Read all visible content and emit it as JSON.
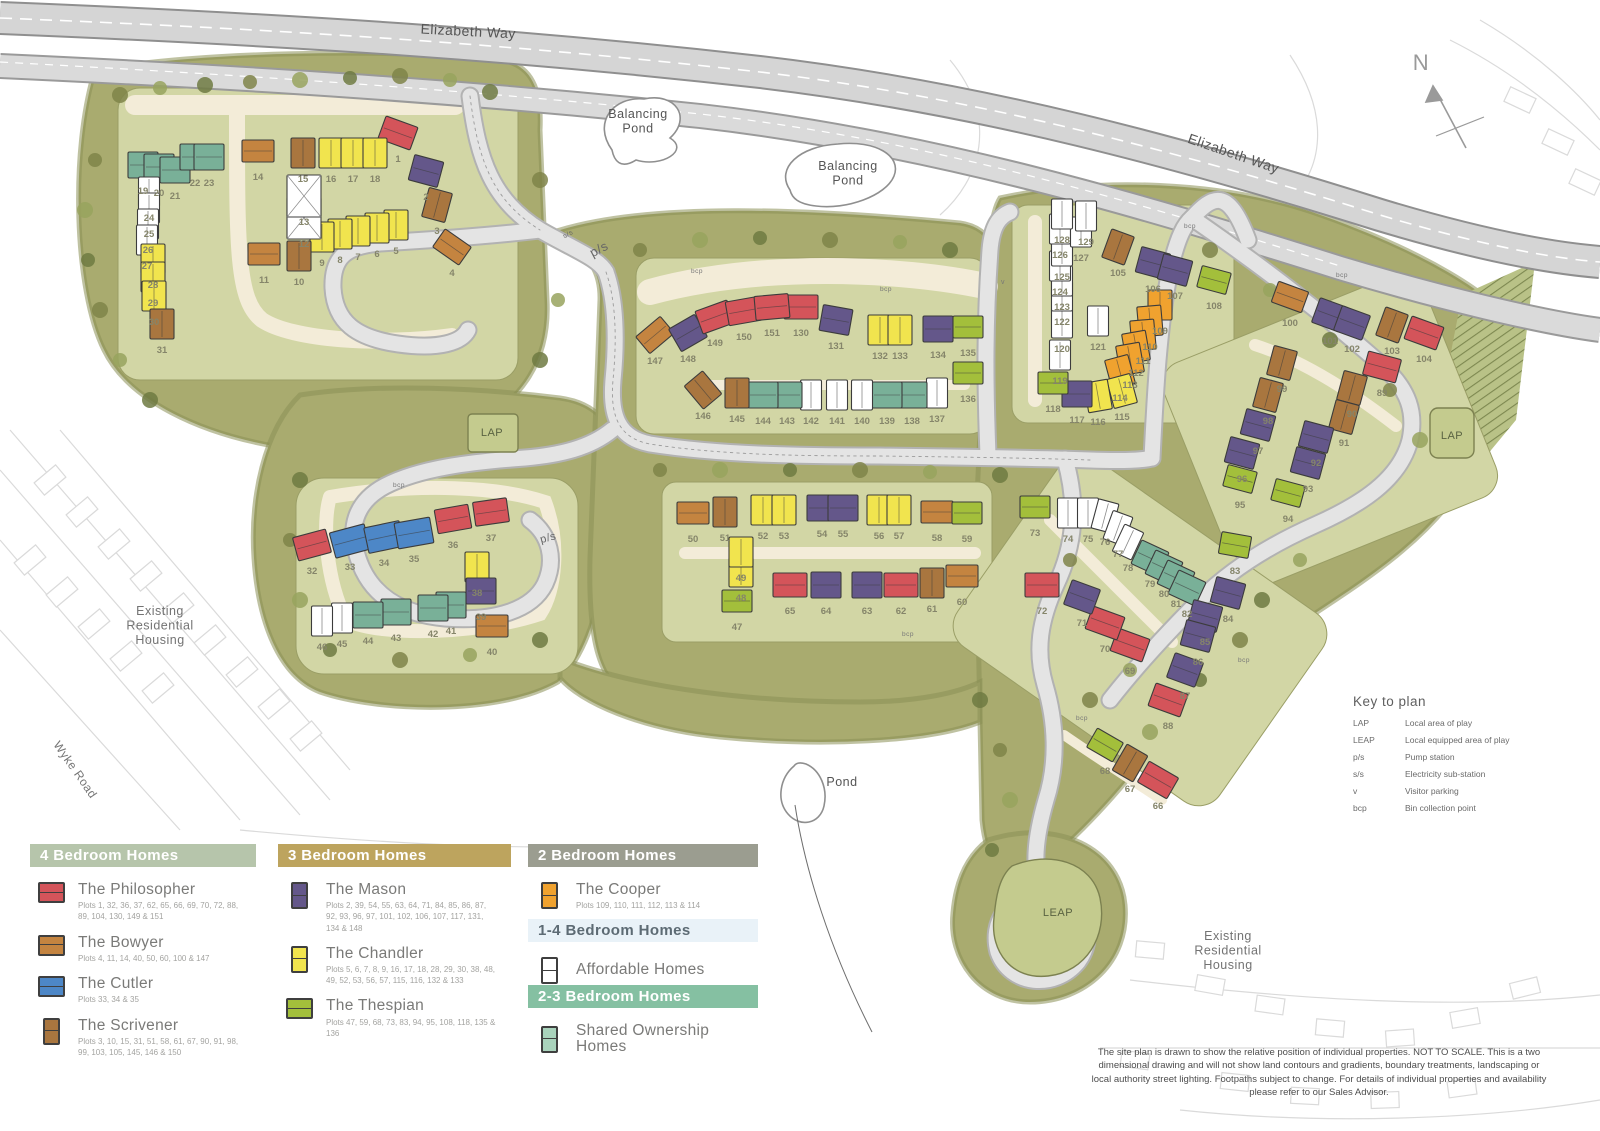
{
  "legend": {
    "panels": [
      {
        "title": "4 Bedroom Homes",
        "header_bg": "#b6c5ab",
        "entries": [
          {
            "name": "The Philosopher",
            "plots": "Plots 1, 32, 36, 37, 62, 65, 66, 69, 70, 72, 88, 89, 104, 130, 149 & 151",
            "color": "#d4545a",
            "shape": "h"
          },
          {
            "name": "The Bowyer",
            "plots": "Plots 4, 11, 14, 40, 50, 60, 100 & 147",
            "color": "#c48440",
            "shape": "h"
          },
          {
            "name": "The Cutler",
            "plots": "Plots 33, 34 & 35",
            "color": "#4d87c7",
            "shape": "h"
          },
          {
            "name": "The Scrivener",
            "plots": "Plots 3, 10, 15, 31, 51, 58, 61, 67, 90, 91, 98, 99, 103, 105, 145, 146 & 150",
            "color": "#a9763f",
            "shape": "v"
          }
        ]
      },
      {
        "title": "3 Bedroom Homes",
        "header_bg": "#bda45e",
        "entries": [
          {
            "name": "The Mason",
            "plots": "Plots 2, 39, 54, 55, 63, 64, 71, 84, 85, 86, 87, 92, 93, 96, 97, 101, 102, 106, 107, 117, 131, 134 & 148",
            "color": "#64578a",
            "shape": "v"
          },
          {
            "name": "The Chandler",
            "plots": "Plots 5, 6, 7, 8, 9, 16, 17, 18, 28, 29, 30, 38, 48, 49, 52, 53, 56, 57, 115, 116, 132 & 133",
            "color": "#f1e44e",
            "shape": "v"
          },
          {
            "name": "The Thespian",
            "plots": "Plots 47, 59, 68, 73, 83, 94, 95, 108, 118, 135 & 136",
            "color": "#a3bf3b",
            "shape": "h"
          }
        ]
      },
      {
        "title": "2 Bedroom Homes",
        "header_bg": "#9b9d90",
        "entries": [
          {
            "name": "The Cooper",
            "plots": "Plots 109, 110, 111, 112, 113 & 114",
            "color": "#f0a22f",
            "shape": "v"
          }
        ]
      },
      {
        "title": "1-4 Bedroom Homes",
        "header_bg": "#e9f2f8",
        "entries": [
          {
            "name": "Affordable Homes",
            "plots": "",
            "color": "#ffffff",
            "shape": "v"
          }
        ]
      },
      {
        "title": "2-3 Bedroom Homes",
        "header_bg": "#85c0a2",
        "entries": [
          {
            "name": "Shared Ownership Homes",
            "plots": "",
            "color": "#a9d3bc",
            "shape": "v"
          }
        ]
      }
    ]
  },
  "key_to_plan": {
    "title": "Key to plan",
    "rows": [
      [
        "LAP",
        "Local area of play"
      ],
      [
        "LEAP",
        "Local equipped area of play"
      ],
      [
        "p/s",
        "Pump station"
      ],
      [
        "s/s",
        "Electricity sub-station"
      ],
      [
        "v",
        "Visitor parking"
      ],
      [
        "bcp",
        "Bin collection point"
      ]
    ]
  },
  "disclaimer": "The site plan is drawn to show the relative position of individual properties. NOT TO SCALE. This is a two dimensional drawing and will not show land contours and gradients, boundary treatments, landscaping or local authority street lighting. Footpaths subject to change. For details of individual properties and availability please refer to our Sales Advisor.",
  "compass": {
    "label": "N"
  },
  "map_labels": [
    {
      "t": "Elizabeth Way",
      "x": 468,
      "y": 36,
      "r": 3,
      "s": 14,
      "c": "#555555"
    },
    {
      "t": "Elizabeth Way",
      "x": 1232,
      "y": 158,
      "r": 19,
      "s": 14,
      "c": "#555555"
    },
    {
      "t": "Balancing|Pond",
      "x": 638,
      "y": 118,
      "r": 0,
      "s": 12.5,
      "c": "#555555"
    },
    {
      "t": "Balancing|Pond",
      "x": 848,
      "y": 170,
      "r": 0,
      "s": 12.5,
      "c": "#555555"
    },
    {
      "t": "Pond",
      "x": 842,
      "y": 786,
      "r": 0,
      "s": 12.5,
      "c": "#555555"
    },
    {
      "t": "Wyke Road",
      "x": 72,
      "y": 772,
      "r": 55,
      "s": 12,
      "c": "#767676"
    },
    {
      "t": "Existing|Residential|Housing",
      "x": 160,
      "y": 615,
      "r": 0,
      "s": 12.5,
      "c": "#737373"
    },
    {
      "t": "Existing|Residential|Housing",
      "x": 1228,
      "y": 940,
      "r": 0,
      "s": 12.5,
      "c": "#737373"
    },
    {
      "t": "LAP",
      "x": 492,
      "y": 436,
      "r": 0,
      "s": 11,
      "c": "#5a6342"
    },
    {
      "t": "LAP",
      "x": 1452,
      "y": 439,
      "r": 0,
      "s": 11,
      "c": "#5a6342"
    },
    {
      "t": "LEAP",
      "x": 1058,
      "y": 916,
      "r": 0,
      "s": 11,
      "c": "#5a6342"
    },
    {
      "t": "p/s",
      "x": 601,
      "y": 253,
      "r": -28,
      "s": 13,
      "c": "#666666"
    },
    {
      "t": "p/s",
      "x": 549,
      "y": 541,
      "r": -15,
      "s": 11,
      "c": "#666666"
    },
    {
      "t": "s/s",
      "x": 569,
      "y": 236,
      "r": -28,
      "s": 7,
      "c": "#666666"
    },
    {
      "t": "v",
      "x": 1003,
      "y": 284,
      "r": 0,
      "s": 7,
      "c": "#777777"
    },
    {
      "t": "bcp",
      "x": 697,
      "y": 273,
      "r": 0,
      "s": 6.5,
      "c": "#777777"
    },
    {
      "t": "bcp",
      "x": 886,
      "y": 291,
      "r": 0,
      "s": 6.5,
      "c": "#777777"
    },
    {
      "t": "bcp",
      "x": 1190,
      "y": 228,
      "r": 0,
      "s": 6.5,
      "c": "#777777"
    },
    {
      "t": "bcp",
      "x": 1342,
      "y": 277,
      "r": 0,
      "s": 6.5,
      "c": "#777777"
    },
    {
      "t": "bcp",
      "x": 399,
      "y": 487,
      "r": 0,
      "s": 6.5,
      "c": "#777777"
    },
    {
      "t": "bcp",
      "x": 908,
      "y": 636,
      "r": 0,
      "s": 6.5,
      "c": "#777777"
    },
    {
      "t": "bcp",
      "x": 1244,
      "y": 662,
      "r": 0,
      "s": 6.5,
      "c": "#777777"
    },
    {
      "t": "bcp",
      "x": 1082,
      "y": 720,
      "r": 0,
      "s": 6.5,
      "c": "#777777"
    },
    {
      "t": "N",
      "x": 1421,
      "y": 70,
      "r": 0,
      "s": 22,
      "c": "#9a9a9a"
    }
  ],
  "house_types": {
    "P": {
      "name": "The Philosopher",
      "color": "#d4545a",
      "w": 34,
      "h": 24
    },
    "B": {
      "name": "The Bowyer",
      "color": "#c48440",
      "w": 32,
      "h": 22
    },
    "C": {
      "name": "The Cutler",
      "color": "#4d87c7",
      "w": 36,
      "h": 26
    },
    "S": {
      "name": "The Scrivener",
      "color": "#a9763f",
      "w": 24,
      "h": 30
    },
    "M": {
      "name": "The Mason",
      "color": "#64578a",
      "w": 30,
      "h": 26
    },
    "H": {
      "name": "The Chandler",
      "color": "#f1e44e",
      "w": 24,
      "h": 30
    },
    "T": {
      "name": "The Thespian",
      "color": "#a3bf3b",
      "w": 30,
      "h": 22
    },
    "O": {
      "name": "The Cooper",
      "color": "#f0a22f",
      "w": 24,
      "h": 30
    },
    "A": {
      "name": "Affordable",
      "color": "#ffffff",
      "w": 21,
      "h": 30
    },
    "W": {
      "name": "Shared Ownership",
      "color": "#79b098",
      "w": 30,
      "h": 26
    },
    "G": {
      "name": "Affordable",
      "color": "#ffffff",
      "w": 34,
      "h": 42
    }
  },
  "houses": [
    [
      1,
      398,
      148,
      "P",
      20
    ],
    [
      2,
      426,
      186,
      "M",
      15
    ],
    [
      3,
      437,
      220,
      "S",
      15
    ],
    [
      4,
      452,
      262,
      "B",
      35
    ],
    [
      5,
      396,
      240,
      "H",
      0
    ],
    [
      6,
      377,
      243,
      "H",
      0
    ],
    [
      7,
      358,
      246,
      "H",
      0
    ],
    [
      8,
      340,
      249,
      "H",
      0
    ],
    [
      9,
      322,
      252,
      "H",
      0
    ],
    [
      10,
      299,
      271,
      "S",
      0
    ],
    [
      11,
      264,
      269,
      "B",
      0
    ],
    [
      12,
      304,
      233,
      "G",
      0
    ],
    [
      13,
      304,
      211,
      "G",
      0
    ],
    [
      14,
      258,
      166,
      "B",
      0
    ],
    [
      15,
      303,
      168,
      "S",
      0
    ],
    [
      16,
      331,
      168,
      "H",
      0
    ],
    [
      17,
      353,
      168,
      "H",
      0
    ],
    [
      18,
      375,
      168,
      "H",
      0
    ],
    [
      19,
      143,
      180,
      "W",
      0
    ],
    [
      20,
      159,
      182,
      "W",
      0
    ],
    [
      21,
      175,
      185,
      "W",
      0
    ],
    [
      22,
      195,
      172,
      "W",
      0
    ],
    [
      23,
      209,
      172,
      "W",
      0
    ],
    [
      24,
      149,
      207,
      "A",
      0
    ],
    [
      25,
      149,
      223,
      "A",
      0
    ],
    [
      26,
      148,
      239,
      "A",
      0
    ],
    [
      27,
      147,
      255,
      "A",
      0
    ],
    [
      28,
      153,
      274,
      "H",
      0
    ],
    [
      29,
      153,
      292,
      "H",
      0
    ],
    [
      30,
      154,
      311,
      "H",
      0
    ],
    [
      31,
      162,
      339,
      "S",
      0
    ],
    [
      32,
      312,
      560,
      "P",
      -15
    ],
    [
      33,
      350,
      556,
      "C",
      -15
    ],
    [
      34,
      384,
      552,
      "C",
      -12
    ],
    [
      35,
      414,
      548,
      "C",
      -10
    ],
    [
      36,
      453,
      534,
      "P",
      -10
    ],
    [
      37,
      491,
      527,
      "P",
      -8
    ],
    [
      38,
      477,
      582,
      "H",
      0
    ],
    [
      39,
      481,
      606,
      "M",
      0
    ],
    [
      40,
      492,
      641,
      "B",
      0
    ],
    [
      41,
      451,
      620,
      "W",
      0
    ],
    [
      42,
      433,
      623,
      "W",
      0
    ],
    [
      43,
      396,
      627,
      "W",
      0
    ],
    [
      44,
      368,
      630,
      "W",
      0
    ],
    [
      45,
      342,
      633,
      "A",
      0
    ],
    [
      46,
      322,
      636,
      "A",
      0
    ],
    [
      47,
      737,
      616,
      "T",
      0
    ],
    [
      48,
      741,
      587,
      "H",
      0
    ],
    [
      49,
      741,
      567,
      "H",
      0
    ],
    [
      50,
      693,
      528,
      "B",
      0
    ],
    [
      51,
      725,
      527,
      "S",
      0
    ],
    [
      52,
      763,
      525,
      "H",
      0
    ],
    [
      53,
      784,
      525,
      "H",
      0
    ],
    [
      54,
      822,
      523,
      "M",
      0
    ],
    [
      55,
      843,
      523,
      "M",
      0
    ],
    [
      56,
      879,
      525,
      "H",
      0
    ],
    [
      57,
      899,
      525,
      "H",
      0
    ],
    [
      58,
      937,
      527,
      "B",
      0
    ],
    [
      59,
      967,
      528,
      "T",
      0
    ],
    [
      60,
      962,
      591,
      "B",
      0
    ],
    [
      61,
      932,
      598,
      "S",
      0
    ],
    [
      62,
      901,
      600,
      "P",
      0
    ],
    [
      63,
      867,
      600,
      "M",
      0
    ],
    [
      64,
      826,
      600,
      "M",
      0
    ],
    [
      65,
      790,
      600,
      "P",
      0
    ],
    [
      66,
      1158,
      795,
      "P",
      30
    ],
    [
      67,
      1130,
      778,
      "S",
      30
    ],
    [
      68,
      1105,
      760,
      "T",
      30
    ],
    [
      69,
      1130,
      660,
      "P",
      20
    ],
    [
      70,
      1105,
      638,
      "P",
      20
    ],
    [
      71,
      1082,
      612,
      "M",
      20
    ],
    [
      72,
      1042,
      600,
      "P",
      0
    ],
    [
      73,
      1035,
      522,
      "T",
      0
    ],
    [
      74,
      1068,
      528,
      "A",
      0
    ],
    [
      75,
      1088,
      528,
      "A",
      0
    ],
    [
      76,
      1105,
      531,
      "A",
      15
    ],
    [
      77,
      1118,
      543,
      "A",
      20
    ],
    [
      78,
      1128,
      557,
      "A",
      25
    ],
    [
      79,
      1150,
      573,
      "W",
      25
    ],
    [
      80,
      1164,
      583,
      "W",
      25
    ],
    [
      81,
      1176,
      593,
      "W",
      25
    ],
    [
      82,
      1187,
      603,
      "W",
      25
    ],
    [
      83,
      1235,
      560,
      "T",
      10
    ],
    [
      84,
      1228,
      608,
      "M",
      15
    ],
    [
      85,
      1205,
      631,
      "M",
      15
    ],
    [
      86,
      1198,
      651,
      "M",
      15
    ],
    [
      87,
      1185,
      685,
      "M",
      20
    ],
    [
      88,
      1168,
      715,
      "P",
      20
    ],
    [
      89,
      1382,
      382,
      "P",
      15
    ],
    [
      90,
      1352,
      403,
      "S",
      15
    ],
    [
      91,
      1344,
      432,
      "S",
      15
    ],
    [
      92,
      1316,
      452,
      "M",
      15
    ],
    [
      93,
      1308,
      478,
      "M",
      15
    ],
    [
      94,
      1288,
      508,
      "T",
      15
    ],
    [
      95,
      1240,
      494,
      "T",
      15
    ],
    [
      96,
      1242,
      468,
      "M",
      15
    ],
    [
      97,
      1258,
      440,
      "M",
      15
    ],
    [
      98,
      1268,
      410,
      "S",
      15
    ],
    [
      99,
      1282,
      378,
      "S",
      15
    ],
    [
      100,
      1290,
      312,
      "B",
      20
    ],
    [
      101,
      1330,
      330,
      "M",
      20
    ],
    [
      102,
      1352,
      338,
      "M",
      20
    ],
    [
      103,
      1392,
      340,
      "S",
      20
    ],
    [
      104,
      1424,
      348,
      "P",
      20
    ],
    [
      105,
      1118,
      262,
      "S",
      20
    ],
    [
      106,
      1153,
      278,
      "M",
      15
    ],
    [
      107,
      1175,
      285,
      "M",
      15
    ],
    [
      108,
      1214,
      295,
      "T",
      15
    ],
    [
      109,
      1160,
      320,
      "O",
      0
    ],
    [
      110,
      1150,
      336,
      "O",
      -5
    ],
    [
      111,
      1143,
      350,
      "O",
      -5
    ],
    [
      112,
      1136,
      362,
      "O",
      -10
    ],
    [
      113,
      1130,
      374,
      "O",
      -10
    ],
    [
      114,
      1120,
      387,
      "O",
      -15
    ],
    [
      115,
      1122,
      406,
      "H",
      -15
    ],
    [
      116,
      1098,
      411,
      "H",
      -10
    ],
    [
      117,
      1077,
      409,
      "M",
      0
    ],
    [
      118,
      1053,
      398,
      "T",
      0
    ],
    [
      119,
      1060,
      370,
      "A",
      0
    ],
    [
      120,
      1062,
      338,
      "A",
      0
    ],
    [
      121,
      1098,
      336,
      "A",
      0
    ],
    [
      122,
      1062,
      311,
      "A",
      0
    ],
    [
      123,
      1062,
      296,
      "A",
      0
    ],
    [
      124,
      1060,
      281,
      "A",
      0
    ],
    [
      125,
      1062,
      266,
      "A",
      0
    ],
    [
      126,
      1060,
      244,
      "A",
      0
    ],
    [
      127,
      1081,
      247,
      "A",
      0
    ],
    [
      128,
      1062,
      229,
      "A",
      0
    ],
    [
      129,
      1086,
      231,
      "A",
      0
    ],
    [
      130,
      801,
      322,
      "P",
      0
    ],
    [
      131,
      836,
      335,
      "M",
      10
    ],
    [
      132,
      880,
      345,
      "H",
      0
    ],
    [
      133,
      900,
      345,
      "H",
      0
    ],
    [
      134,
      938,
      344,
      "M",
      0
    ],
    [
      135,
      968,
      342,
      "T",
      0
    ],
    [
      136,
      968,
      388,
      "T",
      0
    ],
    [
      137,
      937,
      408,
      "A",
      0
    ],
    [
      138,
      912,
      410,
      "W",
      0
    ],
    [
      139,
      887,
      410,
      "W",
      0
    ],
    [
      140,
      862,
      410,
      "A",
      0
    ],
    [
      141,
      837,
      410,
      "A",
      0
    ],
    [
      142,
      811,
      410,
      "A",
      0
    ],
    [
      143,
      787,
      410,
      "W",
      0
    ],
    [
      144,
      763,
      410,
      "W",
      0
    ],
    [
      145,
      737,
      408,
      "S",
      0
    ],
    [
      146,
      703,
      405,
      "S",
      -40
    ],
    [
      147,
      655,
      350,
      "B",
      -40
    ],
    [
      148,
      688,
      348,
      "M",
      -30
    ],
    [
      149,
      715,
      332,
      "P",
      -20
    ],
    [
      150,
      744,
      326,
      "P",
      -10
    ],
    [
      151,
      772,
      322,
      "P",
      -5
    ]
  ]
}
